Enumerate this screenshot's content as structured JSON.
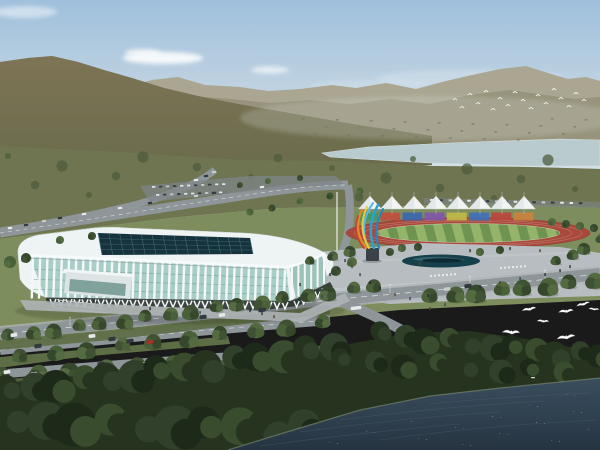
{
  "meta": {
    "description": "Aerial architectural rendering of a riverside sports complex: white ribbed indoor arena with glass curtain wall and dark grid skylight, outdoor athletics track with white membrane canopies and multicolor panel wall, blue-and-orange flame sculpture, plaza with reflecting pool, tree-lined boulevards with cars, dark waterfront forest, river, mountains and flying white birds",
    "width": 600,
    "height": 450
  },
  "palette": {
    "sky_top": "#9fc0dc",
    "sky_mid": "#c6d6e2",
    "sky_horizon": "#e4e9ea",
    "cloud": "#f8fbfc",
    "far_ridge": "#aaa692",
    "far_ridge_2": "#97927b",
    "mountain_hi": "#7d7454",
    "mountain_lo": "#6a6c4d",
    "mountain_dot_dark": "#55523a",
    "mountain_dot_light": "#8f8a62",
    "river": "#b9cbce",
    "tree_band": "#6e7650",
    "tree_blob": "#4f5c3c",
    "parkland": "#7e8d5d",
    "grass_fg": "#5d6d45",
    "grass_dark": "#505f3c",
    "road": "#8f969a",
    "road_dark": "#7e8588",
    "sidewalk": "#aeb4b6",
    "lane_mark": "#e8eceb",
    "plaza": "#b7bdc0",
    "pool": "#16404c",
    "pool_wave": "#3b6a74",
    "arena_white": "#eef3f4",
    "arena_rib": "#f4f8f8",
    "arena_glass": "#a9cec7",
    "arena_glass_r": "#9dc2ba",
    "arena_glass_dark": "#6d9a92",
    "skylight": "#16333d",
    "skylight_grid": "#44707c",
    "arcade_shadow": "#28322e",
    "track_red": "#a8493b",
    "infield_light": "#94b469",
    "infield_dark": "#6f9350",
    "tent_white": "#f2f4f3",
    "tent_shade": "#d9e0e1",
    "panel_colors": [
      "#3e9a5e",
      "#bf4f3c",
      "#3a66b0",
      "#7e57a8",
      "#c0ba48",
      "#4170ba",
      "#b8473f",
      "#c8833c"
    ],
    "sculpture_blue": "#2da0d8",
    "sculpture_blue_dark": "#1f86c8",
    "sculpture_blue_light": "#55b8e4",
    "sculpture_orange": "#e08a2a",
    "sculpture_yellow": "#ecc93e",
    "sculpture_red": "#c44430",
    "pedestal": "#3a4148",
    "dark_trees": "#26331f",
    "dark_trees_2": "#31402a",
    "dark_trees_3": "#1e2a19",
    "dark_trees_4": "#3a4c2e",
    "water_top": "#3a4e5e",
    "water_bottom": "#263441",
    "water_ripple": "#56707f",
    "sparkle": "#a9bdc6",
    "bird_white": "#ffffff",
    "car_white": "#e7eaea",
    "car_dark": "#343b40",
    "car_red": "#a83428",
    "car_silver": "#c7cccd",
    "people_dark": "#2b3136"
  },
  "scene": {
    "clouds": [
      {
        "x": 163,
        "y": 58,
        "rx": 40,
        "ry": 6,
        "o": 0.95
      },
      {
        "x": 143,
        "y": 53,
        "rx": 18,
        "ry": 4,
        "o": 0.8
      },
      {
        "x": 270,
        "y": 70,
        "rx": 19,
        "ry": 3.5,
        "o": 0.7
      },
      {
        "x": 25,
        "y": 12,
        "rx": 32,
        "ry": 6,
        "o": 0.5
      },
      {
        "x": 470,
        "y": 78,
        "rx": 95,
        "ry": 8,
        "o": 0.22
      },
      {
        "x": 370,
        "y": 86,
        "rx": 60,
        "ry": 6,
        "o": 0.18
      }
    ],
    "distant_birds": [
      [
        455,
        100
      ],
      [
        462,
        108
      ],
      [
        470,
        95
      ],
      [
        478,
        104
      ],
      [
        486,
        92
      ],
      [
        493,
        110
      ],
      [
        500,
        99
      ],
      [
        508,
        106
      ],
      [
        515,
        93
      ],
      [
        523,
        101
      ],
      [
        531,
        109
      ],
      [
        538,
        96
      ],
      [
        546,
        104
      ],
      [
        554,
        90
      ],
      [
        561,
        99
      ],
      [
        569,
        107
      ],
      [
        576,
        94
      ],
      [
        584,
        101
      ]
    ],
    "seagulls": [
      {
        "x": 529,
        "y": 309,
        "s": 1.0,
        "r": -8
      },
      {
        "x": 543,
        "y": 321,
        "s": 0.85,
        "r": 6
      },
      {
        "x": 566,
        "y": 311,
        "s": 1.05,
        "r": -4
      },
      {
        "x": 583,
        "y": 304,
        "s": 0.95,
        "r": -12
      },
      {
        "x": 594,
        "y": 309,
        "s": 0.75,
        "r": 8
      },
      {
        "x": 566,
        "y": 337,
        "s": 1.3,
        "r": -6
      },
      {
        "x": 511,
        "y": 332,
        "s": 1.25,
        "r": 5
      }
    ],
    "tents": {
      "x0": 370,
      "dx": 22,
      "count": 8,
      "peak_y": 196,
      "base_y": 209,
      "half_w": 11.5
    },
    "panels": {
      "x0": 358,
      "y": 212.5,
      "w": 20,
      "gap": 2.2,
      "h": 8
    },
    "track": {
      "cx": 468,
      "cy": 233,
      "rx": 122,
      "ry": 15.5,
      "inner_rx": 92,
      "inner_ry": 9.5
    },
    "pool": {
      "cx": 441,
      "cy": 261,
      "rx": 39,
      "ry": 6.5
    },
    "flagpole": {
      "x": 337,
      "y1": 192,
      "y2": 272
    },
    "cars_fg": [
      {
        "x": 14,
        "y": 335,
        "c": "car_white"
      },
      {
        "x": 38,
        "y": 346,
        "c": "car_dark"
      },
      {
        "x": 92,
        "y": 336,
        "c": "car_white"
      },
      {
        "x": 112,
        "y": 339,
        "c": "car_dark"
      },
      {
        "x": 130,
        "y": 341,
        "c": "car_dark"
      },
      {
        "x": 150,
        "y": 342,
        "c": "car_red"
      },
      {
        "x": 203,
        "y": 317,
        "c": "car_dark"
      },
      {
        "x": 222,
        "y": 315,
        "c": "car_white"
      },
      {
        "x": 262,
        "y": 310,
        "c": "car_dark"
      },
      {
        "x": 447,
        "y": 289,
        "c": "car_silver"
      },
      {
        "x": 468,
        "y": 286,
        "c": "car_dark"
      },
      {
        "x": 7,
        "y": 372,
        "c": "car_white"
      },
      {
        "x": 34,
        "y": 374,
        "c": "car_white"
      },
      {
        "x": 85,
        "y": 369,
        "c": "car_red"
      },
      {
        "x": 101,
        "y": 364,
        "c": "car_dark"
      },
      {
        "x": 143,
        "y": 364,
        "c": "car_white"
      },
      {
        "x": 158,
        "y": 362,
        "c": "car_silver"
      },
      {
        "x": 356,
        "y": 308,
        "c": "car_white",
        "l": 11
      }
    ],
    "cars_mid": [
      [
        10,
        228
      ],
      [
        26,
        225
      ],
      [
        44,
        221
      ],
      [
        60,
        218
      ],
      [
        84,
        214
      ],
      [
        120,
        208
      ],
      [
        150,
        203
      ],
      [
        196,
        196
      ],
      [
        214,
        193
      ],
      [
        262,
        187
      ],
      [
        196,
        180
      ],
      [
        206,
        176
      ],
      [
        214,
        172
      ]
    ],
    "parking_rows": [
      {
        "x0": 152,
        "y": 186,
        "n": 11,
        "dx": 7,
        "slope": -0.04
      },
      {
        "x0": 156,
        "y": 194,
        "n": 10,
        "dx": 7,
        "slope": -0.04
      }
    ],
    "car_row_right": {
      "x0": 430,
      "y0": 199,
      "n": 17,
      "dx": 9.3,
      "slope": 0.2
    },
    "people": [
      [
        345,
        262
      ],
      [
        352,
        268
      ],
      [
        360,
        276
      ],
      [
        370,
        284
      ],
      [
        380,
        290
      ],
      [
        395,
        296
      ],
      [
        410,
        300
      ],
      [
        428,
        297
      ],
      [
        300,
        286
      ],
      [
        312,
        292
      ],
      [
        322,
        298
      ],
      [
        250,
        312
      ],
      [
        262,
        315
      ],
      [
        274,
        318
      ],
      [
        200,
        314
      ],
      [
        150,
        310
      ],
      [
        480,
        288
      ],
      [
        500,
        284
      ],
      [
        520,
        280
      ],
      [
        545,
        276
      ],
      [
        560,
        272
      ],
      [
        420,
        265
      ],
      [
        450,
        258
      ],
      [
        470,
        252
      ],
      [
        510,
        250
      ],
      [
        540,
        252
      ],
      [
        86,
        300
      ],
      [
        94,
        303
      ],
      [
        570,
        268
      ],
      [
        430,
        310
      ],
      [
        445,
        306
      ],
      [
        330,
        276
      ],
      [
        338,
        270
      ]
    ],
    "tree_rows": [
      {
        "x0": 8,
        "y0": 336,
        "x1": 374,
        "y1": 286,
        "n": 17,
        "r": 7
      },
      {
        "x0": 20,
        "y0": 357,
        "x1": 320,
        "y1": 323,
        "n": 10,
        "r": 8
      },
      {
        "x0": 430,
        "y0": 297,
        "x1": 592,
        "y1": 281,
        "n": 8,
        "r": 8.5
      },
      {
        "x0": 2,
        "y0": 376,
        "x1": 205,
        "y1": 361,
        "n": 7,
        "r": 9
      },
      {
        "x0": 310,
        "y0": 262,
        "x1": 350,
        "y1": 250,
        "n": 3,
        "r": 5
      },
      {
        "x0": 556,
        "y0": 262,
        "x1": 598,
        "y1": 240,
        "n": 4,
        "r": 5.5
      }
    ],
    "park_trees": [
      [
        390,
        252,
        4
      ],
      [
        402,
        248,
        4
      ],
      [
        418,
        247,
        4
      ],
      [
        352,
        262,
        5
      ],
      [
        336,
        271,
        5
      ],
      [
        10,
        262,
        6
      ],
      [
        26,
        258,
        5
      ],
      [
        60,
        240,
        4
      ],
      [
        92,
        236,
        4
      ],
      [
        250,
        212,
        3.5
      ],
      [
        272,
        208,
        3.5
      ],
      [
        300,
        201,
        3.5
      ],
      [
        330,
        196,
        3.5
      ],
      [
        360,
        191,
        3.5
      ],
      [
        300,
        178,
        3
      ],
      [
        268,
        181,
        3
      ],
      [
        240,
        185,
        3
      ],
      [
        480,
        252,
        4
      ],
      [
        500,
        250,
        4
      ],
      [
        552,
        222,
        4
      ],
      [
        566,
        224,
        4
      ],
      [
        580,
        226,
        4
      ],
      [
        594,
        228,
        4
      ]
    ],
    "dark_rows": [
      {
        "x0": 6,
        "y0": 390,
        "x1": 330,
        "y1": 347,
        "n": 14,
        "r": 15
      },
      {
        "x0": 380,
        "y0": 334,
        "x1": 598,
        "y1": 356,
        "n": 11,
        "r": 12
      },
      {
        "x0": 10,
        "y0": 420,
        "x1": 300,
        "y1": 428,
        "n": 10,
        "r": 20
      },
      {
        "x0": 340,
        "y0": 360,
        "x1": 560,
        "y1": 372,
        "n": 8,
        "r": 11
      }
    ]
  }
}
